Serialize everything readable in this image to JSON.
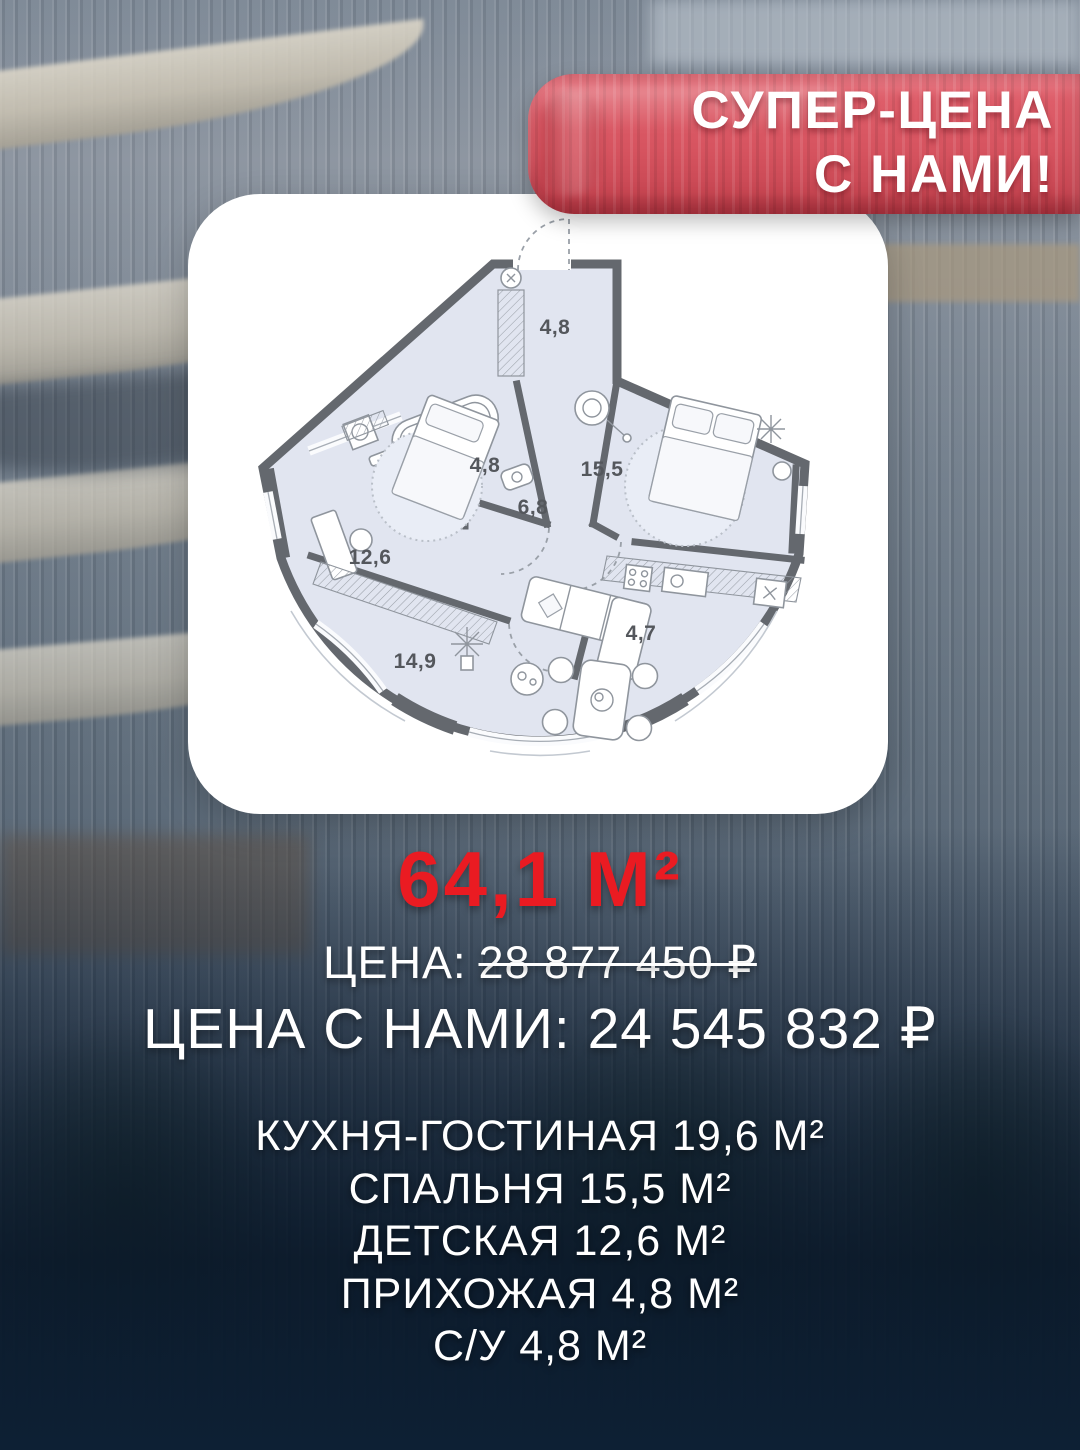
{
  "ribbon": {
    "line1": "СУПЕР-ЦЕНА",
    "line2": "С НАМИ!"
  },
  "area_headline": "64,1 М²",
  "pricing": {
    "old_label": "ЦЕНА:",
    "old_price": "28 877 450 ₽",
    "new_label": "ЦЕНА С НАМИ:",
    "new_price": "24 545 832 ₽"
  },
  "room_list": [
    "КУХНЯ-ГОСТИНАЯ 19,6 М²",
    "СПАЛЬНЯ 15,5 М²",
    "ДЕТСКАЯ 12,6 М²",
    "ПРИХОЖАЯ 4,8 М²",
    "С/У 4,8 М²"
  ],
  "floor_plan": {
    "labels": {
      "hallway": "4,8",
      "bathroom": "4,8",
      "corridor": "6,8",
      "bedroom": "15,5",
      "kids_room": "12,6",
      "living_room": "14,9",
      "kitchen": "4,7"
    }
  },
  "colors": {
    "accent_red": "#ea1b22",
    "ribbon_red": "#d5525f",
    "card_bg": "#ffffff",
    "plan_wall": "#64686e",
    "plan_floor": "#e1e5f0",
    "text": "#ffffff"
  }
}
